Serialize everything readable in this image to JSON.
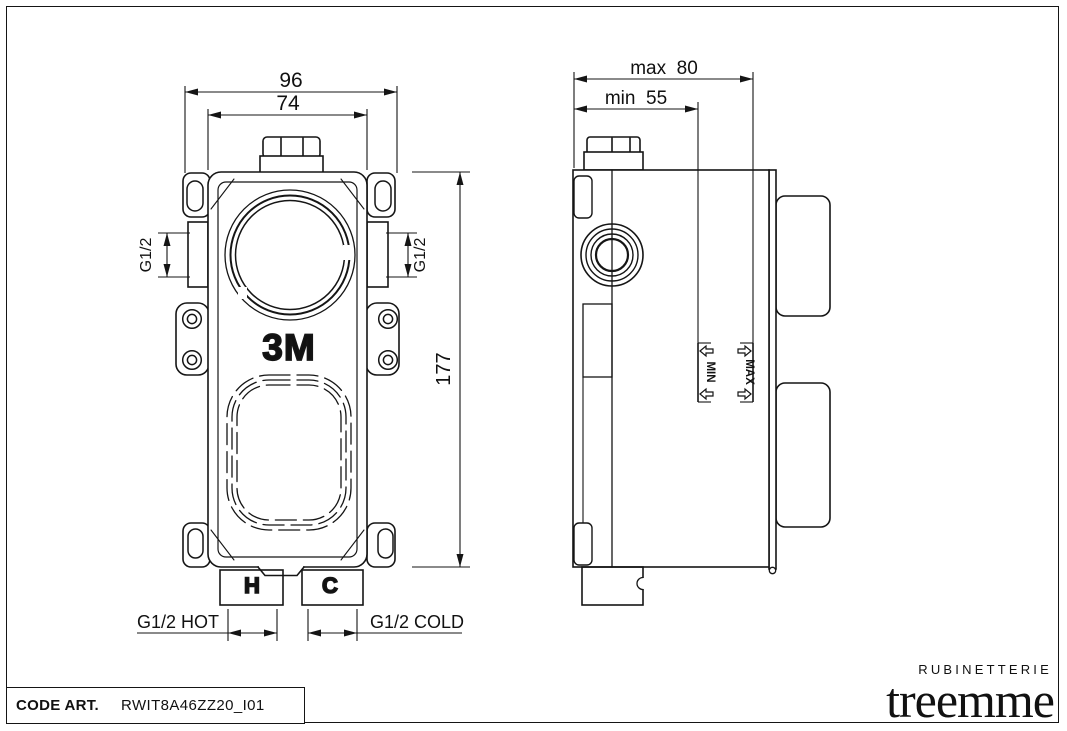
{
  "drawing": {
    "code_label": "CODE ART.",
    "code_value": "RWIT8A46ZZ20_I01",
    "brand": {
      "top": "RUBINETTERIE",
      "name": "treemme"
    },
    "front_view": {
      "dim_width_outer": "96",
      "dim_width_inner": "74",
      "dim_height": "177",
      "thread_left": "G1/2",
      "thread_right": "G1/2",
      "inlet_hot": "G1/2 HOT",
      "inlet_cold": "G1/2 COLD",
      "body_marking": "3M",
      "hot_marking": "H",
      "cold_marking": "C"
    },
    "side_view": {
      "dim_depth_max": "max  80",
      "dim_depth_min": "min  55",
      "marker_min": "MIN",
      "marker_max": "MAX"
    }
  }
}
